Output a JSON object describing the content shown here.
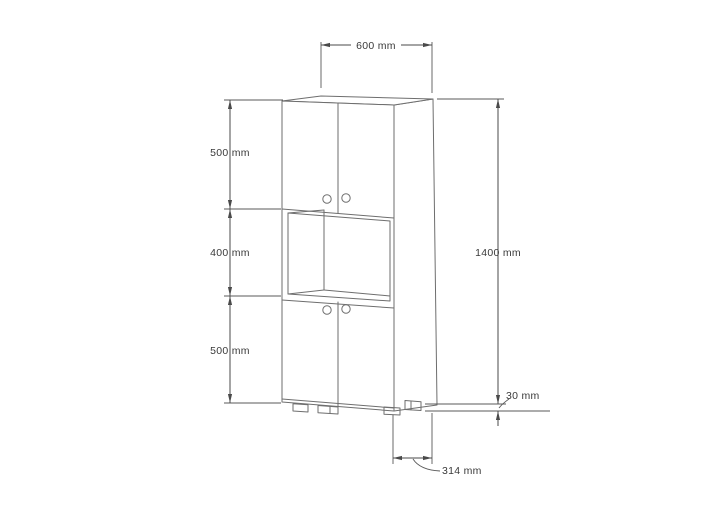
{
  "diagram": {
    "type": "furniture-dimension-drawing",
    "subject": "tall two-door cabinet with open middle shelf",
    "units": "mm",
    "colors": {
      "background": "#ffffff",
      "outline": "#6e6e6e",
      "dimension_line": "#4a4a4a",
      "label_text": "#3a3a3a"
    },
    "dims": {
      "width": "600 mm",
      "section_top": "500 mm",
      "section_middle": "400 mm",
      "section_bottom": "500 mm",
      "height_total": "1400 mm",
      "base_height": "30 mm",
      "depth": "314 mm"
    }
  }
}
